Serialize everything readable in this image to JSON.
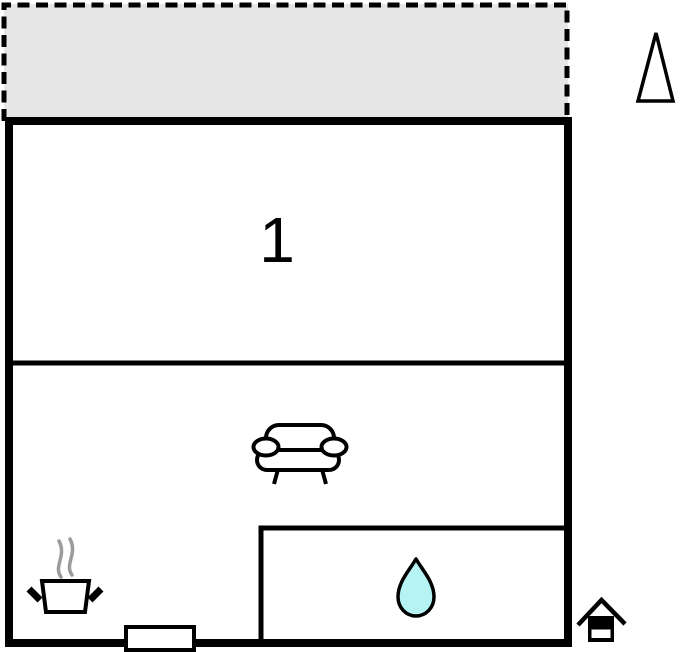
{
  "plan": {
    "room_label": "1",
    "colors": {
      "wall": "#000000",
      "terrace_fill": "#e6e6e6",
      "steam": "#9b9b9b",
      "water_drop_fill": "#b6f4f4",
      "background": "#ffffff"
    },
    "icons": {
      "north_arrow": "north-arrow-icon",
      "sofa": "sofa-icon",
      "cooking_pot": "cooking-pot-icon",
      "steam": "steam-icon",
      "water_drop": "water-drop-icon",
      "door": "door-marker",
      "entrance": "entrance-house-icon"
    }
  }
}
